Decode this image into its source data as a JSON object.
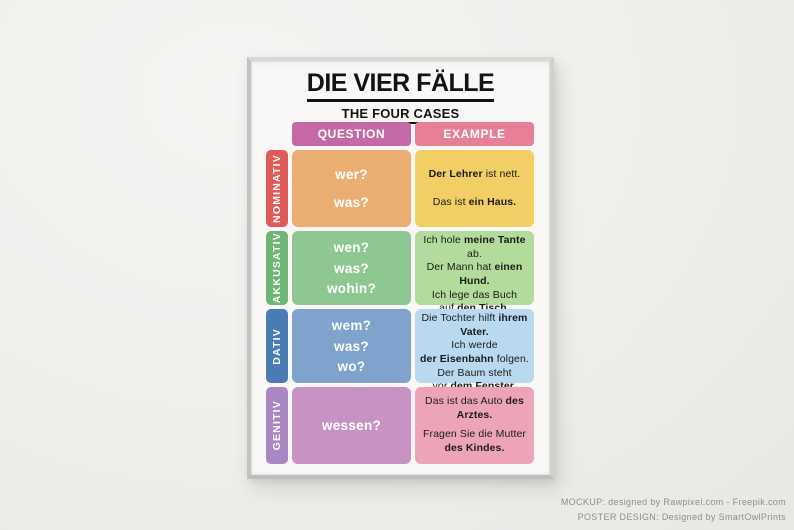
{
  "credits": {
    "line1": "MOCKUP: designed by Rawpixel.com - Freepik.com",
    "line2": "POSTER DESIGN: Designed by SmartOwlPrints"
  },
  "poster": {
    "title": "DIE VIER FÄLLE",
    "subtitle": "THE FOUR CASES",
    "columns": {
      "question": "QUESTION",
      "example": "EXAMPLE"
    },
    "colors": {
      "question_header": "#c569a6",
      "example_header": "#e77f96",
      "text_on_color": "#ffffff",
      "example_text": "#1c1b1a"
    },
    "rows": [
      {
        "case": "NOMINATIV",
        "label_color": "#e05b57",
        "question_color": "#eaae72",
        "example_color": "#f2cf65",
        "questions": [
          "wer?",
          "was?"
        ],
        "examples": [
          [
            [
              {
                "t": "Der Lehrer",
                "b": true
              },
              {
                "t": " ist nett.",
                "b": false
              }
            ]
          ],
          [
            [
              {
                "t": "Das ist ",
                "b": false
              },
              {
                "t": "ein Haus.",
                "b": true
              }
            ]
          ]
        ]
      },
      {
        "case": "AKKUSATIV",
        "label_color": "#6fb676",
        "question_color": "#8fc792",
        "example_color": "#b2db9c",
        "questions": [
          "wen?",
          "was?",
          "wohin?"
        ],
        "examples": [
          [
            [
              {
                "t": "Ich hole ",
                "b": false
              },
              {
                "t": "meine Tante",
                "b": true
              },
              {
                "t": " ab.",
                "b": false
              }
            ]
          ],
          [
            [
              {
                "t": "Der Mann hat ",
                "b": false
              },
              {
                "t": "einen Hund.",
                "b": true
              }
            ]
          ],
          [
            [
              {
                "t": "Ich lege das Buch",
                "b": false
              }
            ],
            [
              {
                "t": "auf ",
                "b": false
              },
              {
                "t": "den Tisch.",
                "b": true
              }
            ]
          ]
        ]
      },
      {
        "case": "DATIV",
        "label_color": "#4a7bb5",
        "question_color": "#7fa3cc",
        "example_color": "#b8d9f0",
        "questions": [
          "wem?",
          "was?",
          "wo?"
        ],
        "examples": [
          [
            [
              {
                "t": "Die Tochter hilft ",
                "b": false
              },
              {
                "t": "ihrem Vater.",
                "b": true
              }
            ]
          ],
          [
            [
              {
                "t": "Ich werde",
                "b": false
              }
            ],
            [
              {
                "t": "der Eisenbahn",
                "b": true
              },
              {
                "t": " folgen.",
                "b": false
              }
            ]
          ],
          [
            [
              {
                "t": "Der Baum steht",
                "b": false
              }
            ],
            [
              {
                "t": "vor ",
                "b": false
              },
              {
                "t": "dem Fenster.",
                "b": true
              }
            ]
          ]
        ]
      },
      {
        "case": "GENITIV",
        "label_color": "#a887c2",
        "question_color": "#c893c3",
        "example_color": "#eda4b8",
        "questions": [
          "wessen?"
        ],
        "examples": [
          [
            [
              {
                "t": "Das ist das Auto ",
                "b": false
              },
              {
                "t": "des Arztes.",
                "b": true
              }
            ]
          ],
          [
            [
              {
                "t": "Fragen Sie die Mutter",
                "b": false
              }
            ],
            [
              {
                "t": "des Kindes.",
                "b": true
              }
            ]
          ]
        ]
      }
    ]
  }
}
